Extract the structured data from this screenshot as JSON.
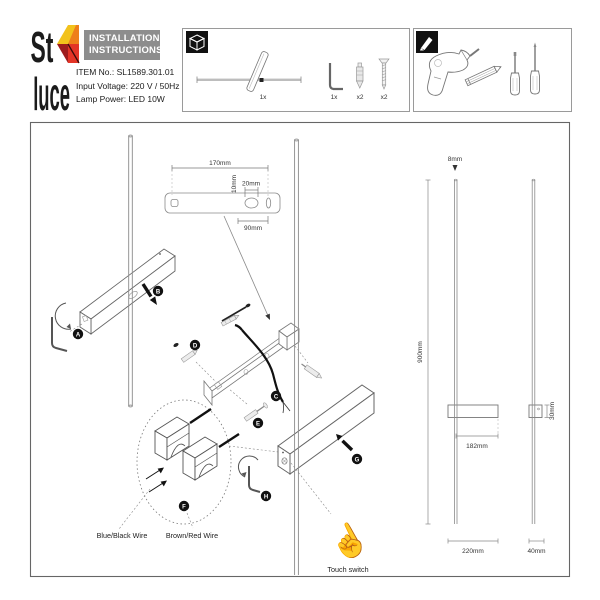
{
  "header": {
    "logo": {
      "line1": "St",
      "line2": "luce",
      "colors": {
        "yellow": "#f2c21c",
        "orange": "#ee7f1b",
        "red": "#e33427",
        "dark_red": "#9e1c1e"
      }
    },
    "title": {
      "line1": "INSTALLATION",
      "line2": "INSTRUCTIONS",
      "bg": "#8d8d8d"
    },
    "specs": {
      "item_no": "ITEM No.: SL1589.301.01",
      "input_voltage": "Input Voltage: 220 V / 50Hz",
      "lamp_power": "Lamp Power: LED 10W"
    }
  },
  "parts_box": {
    "lamp_qty": "1x",
    "hex_key_qty": "1x",
    "anchor_qty": "x2",
    "screw_qty": "x2"
  },
  "diagram": {
    "dimensions": {
      "bracket_width": "170mm",
      "bracket_hole_width": "20mm",
      "bracket_hole_height": "10mm",
      "bracket_offset": "90mm",
      "rod_diameter": "8mm",
      "lamp_height": "900mm",
      "body_width": "182mm",
      "front_total_width": "220mm",
      "body_height": "30mm",
      "side_width": "40mm"
    },
    "steps": {
      "a": "A",
      "b": "B",
      "c": "C",
      "d": "D",
      "e": "E",
      "f": "F",
      "g": "G",
      "h": "H"
    },
    "labels": {
      "blue_black_wire": "Blue/Black Wire",
      "brown_red_wire": "Brown/Red Wire",
      "touch_switch": "Touch switch"
    },
    "icons": {
      "touch_hand": "☝"
    }
  }
}
